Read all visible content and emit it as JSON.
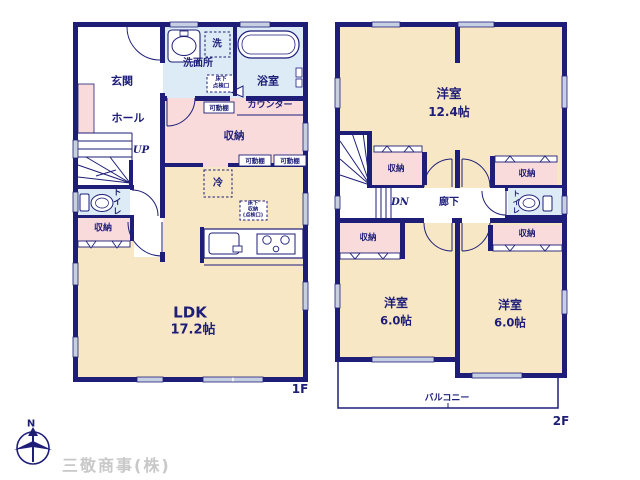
{
  "company_name": "三敬商事(株)",
  "compass": {
    "north_label": "N"
  },
  "colors": {
    "wall": "#1e1e78",
    "room_fill": "#f7e7c5",
    "storage_fill": "#f9dbdb",
    "wet_area_fill": "#dcebf6",
    "window_fill": "#c7cfe2",
    "company_text": "#c8c8c8"
  },
  "floor1": {
    "floor_label": "1F",
    "entrance": "玄関",
    "hall": "ホール",
    "stairs_up": "UP",
    "toilet": "トイレ",
    "toilet_storage": "収納",
    "washroom": "洗面所",
    "washer": "洗",
    "underfloor_hatch": [
      "床下",
      "点検口"
    ],
    "bathroom": "浴室",
    "movable_shelf": "可動棚",
    "counter": "カウンター",
    "storage": "収納",
    "fridge": "冷",
    "underfloor_storage": [
      "床下",
      "収納",
      "(点検口)"
    ],
    "ldk_name": "LDK",
    "ldk_size": "17.2帖"
  },
  "floor2": {
    "floor_label": "2F",
    "main_bedroom": {
      "name": "洋室",
      "size": "12.4帖"
    },
    "bedroom_left": {
      "name": "洋室",
      "size": "6.0帖"
    },
    "bedroom_right": {
      "name": "洋室",
      "size": "6.0帖"
    },
    "storage": "収納",
    "stairs_down": "DN",
    "corridor": "廊下",
    "toilet": "トイレ",
    "balcony": "バルコニー"
  }
}
